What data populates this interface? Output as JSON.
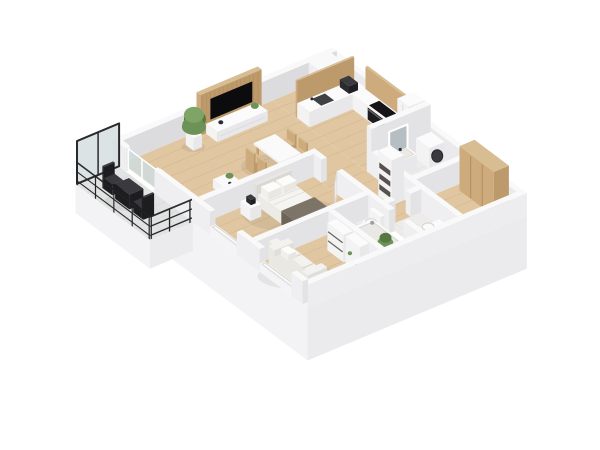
{
  "image": {
    "type": "3d-isometric-floor-plan",
    "description": "Axonometric 3D render of an apartment floor plan with open kitchen and living room, bedroom, two bathrooms, hallway, entry with wardrobes, second room with sofa, and a balcony with black railing",
    "background": "#ffffff"
  },
  "palette": {
    "background": "#ffffff",
    "wallTop": "#f9f9fa",
    "wallSideX": "#e3e3e6",
    "wallSideY": "#efeff1",
    "extInnerX": "#dcdcdf",
    "extInnerY": "#eaeaed",
    "extFaceSE": "#ededef",
    "extFaceSW": "#f4f4f6",
    "slabSE": "#ebebed",
    "slabSW": "#f3f3f5",
    "floorWood": "#e0c7a2",
    "floorWoodLine": "#cdaf87",
    "floorTile": "#edecea",
    "floorTileLine": "#dcdad6",
    "balconyTile": "#e2e3e3",
    "balconyTileLine": "#cfd1d1",
    "woodTop": "#d8bc92",
    "woodX": "#bd9a6c",
    "woodY": "#cdab7d",
    "woodLine": "#b08a58",
    "whiteTop": "#fbfbfc",
    "whiteX": "#e8e8ea",
    "whiteY": "#f3f3f4",
    "black": "#1d1d20",
    "blackTop": "#3a3a3e",
    "tv": "#0c0c0e",
    "applianceTop": "#3a3a3f",
    "applianceX": "#1f1f23",
    "applianceY": "#2b2b2f",
    "cooktop": "#151517",
    "ovenFace": "#1d1d20",
    "sinkDark": "#3f4144",
    "duvetTop": "#f5f4f1",
    "duvetX": "#e4e2dd",
    "duvetY": "#edebe6",
    "runnerTop": "#7d7468",
    "runnerX": "#5f574c",
    "runnerY": "#6e6559",
    "pillow": "#fcfcfa",
    "sofaTop": "#f3f2ef",
    "sofaX": "#e0deda",
    "sofaY": "#eae8e3",
    "sofaLine": "#d6d4ce",
    "green": "#6d9257",
    "greenDark": "#567840",
    "greenLight": "#7fa566",
    "mirror": "#b5bec2",
    "glass": "#cfdadc",
    "doorLeaf": "#fdfdfe",
    "doorEdge": "#dededf",
    "shelfDark": "#47403a",
    "shadow": "rgba(60,50,40,0.08)"
  },
  "rooms": [
    {
      "id": "living-room",
      "label": "Living room",
      "floor": "wood",
      "furniture": [
        "tv-feature-wall",
        "tv",
        "media-console",
        "dining-table",
        "dining-chairs",
        "coffee-table",
        "floor-plant"
      ]
    },
    {
      "id": "kitchen",
      "label": "Kitchen",
      "floor": "wood",
      "furniture": [
        "duct-column",
        "backsplash",
        "kitchen-counter",
        "coffee-machine",
        "kitchen-sink",
        "cooktop",
        "oven",
        "tall-cabinet"
      ]
    },
    {
      "id": "bedroom",
      "label": "Bedroom",
      "floor": "wood",
      "furniture": [
        "bed",
        "headboard",
        "pillows",
        "bed-runner",
        "nightstand",
        "window"
      ]
    },
    {
      "id": "bathroom",
      "label": "Bathroom",
      "floor": "tile",
      "furniture": [
        "washing-machine",
        "vanity-sink",
        "mirror"
      ]
    },
    {
      "id": "wc",
      "label": "WC",
      "floor": "tile",
      "furniture": [
        "toilet"
      ]
    },
    {
      "id": "hallway",
      "label": "Hallway",
      "floor": "wood",
      "furniture": [
        "shelf-niche",
        "doors"
      ]
    },
    {
      "id": "entry",
      "label": "Entry",
      "floor": "wood",
      "furniture": [
        "wardrobe",
        "entry-door"
      ]
    },
    {
      "id": "bathroom-2",
      "label": "Bathroom 2",
      "floor": "tile",
      "furniture": [
        "bathtub",
        "toilet",
        "plant"
      ]
    },
    {
      "id": "second-room",
      "label": "Second room",
      "floor": "wood",
      "furniture": [
        "sofa",
        "shelving",
        "window"
      ]
    },
    {
      "id": "balcony",
      "label": "Balcony",
      "floor": "tile",
      "furniture": [
        "glass-screen",
        "railing",
        "bistro-table",
        "bistro-chairs"
      ]
    }
  ]
}
